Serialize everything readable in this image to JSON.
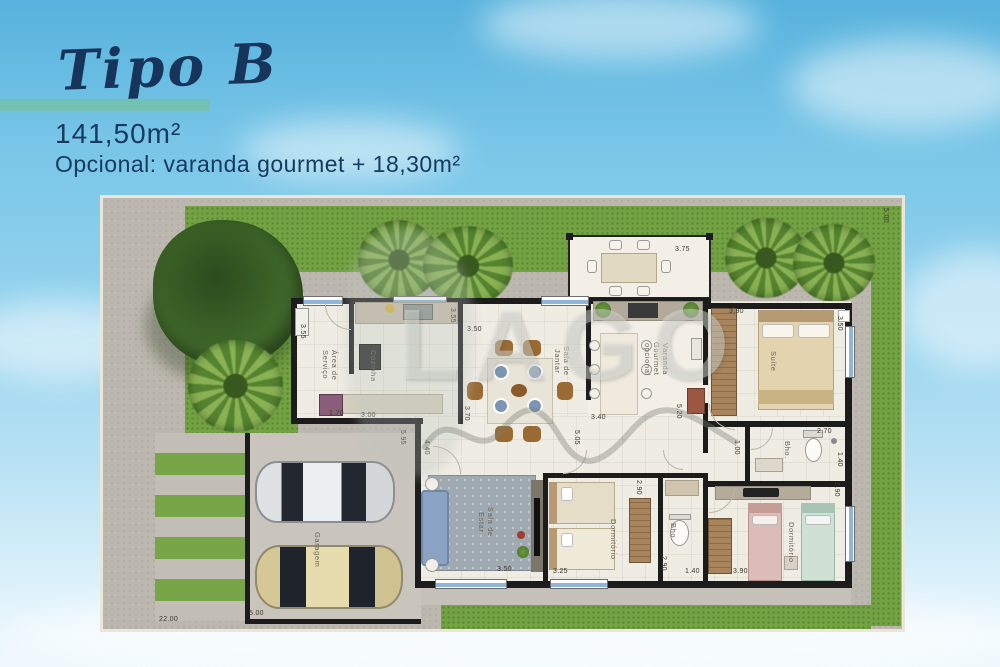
{
  "header": {
    "title": "Tipo B",
    "area": "141,50m²",
    "optional_line": "Opcional: varanda gourmet + 18,30m²"
  },
  "colors": {
    "accent_teal": "#73c1ad",
    "title_navy": "#17345a",
    "lawn_green": "#73a243",
    "wall_black": "#1c1c1c"
  },
  "watermark": {
    "text": "LAGO"
  },
  "rooms": {
    "service": "Área de Serviço",
    "kitchen": "Cozinha",
    "dining": "Sala de Jantar",
    "varanda": "Varanda Gourmet opcional",
    "suite": "Suíte",
    "suite_bath": "Bho.",
    "bath": "Bho.",
    "dorm1": "Dormitório",
    "dorm2": "Dormitório",
    "living": "Sala de Estar",
    "garage": "Garagem"
  },
  "dims": {
    "deck_w": "3.75",
    "lot_side": "5.00",
    "service_h": "3.55",
    "kitchen_h": "3.55",
    "kitchen_w": "3.00",
    "service_w": "1.70",
    "dining_w": "3.50",
    "dining_h": "3.70",
    "left_h1": "5.95",
    "left_h2": "4.40",
    "dining_s": "5.05",
    "varanda_w": "3.40",
    "varanda_h": "5.20",
    "suite_w": "3.90",
    "suite_h": "3.50",
    "sbath_w": "2.70",
    "sbath_h": "1.40",
    "hall_w": "1.00",
    "mid_h": "2.90",
    "dorm1_w": "3.25",
    "dorm1_h": "2.90",
    "bath_w": "1.40",
    "bath_h": "2.90",
    "dorm2_w": "3.90",
    "dorm2_h": "2.90",
    "living_w": "3.50",
    "garage_w": "5.00",
    "lot_w": "22.00"
  }
}
